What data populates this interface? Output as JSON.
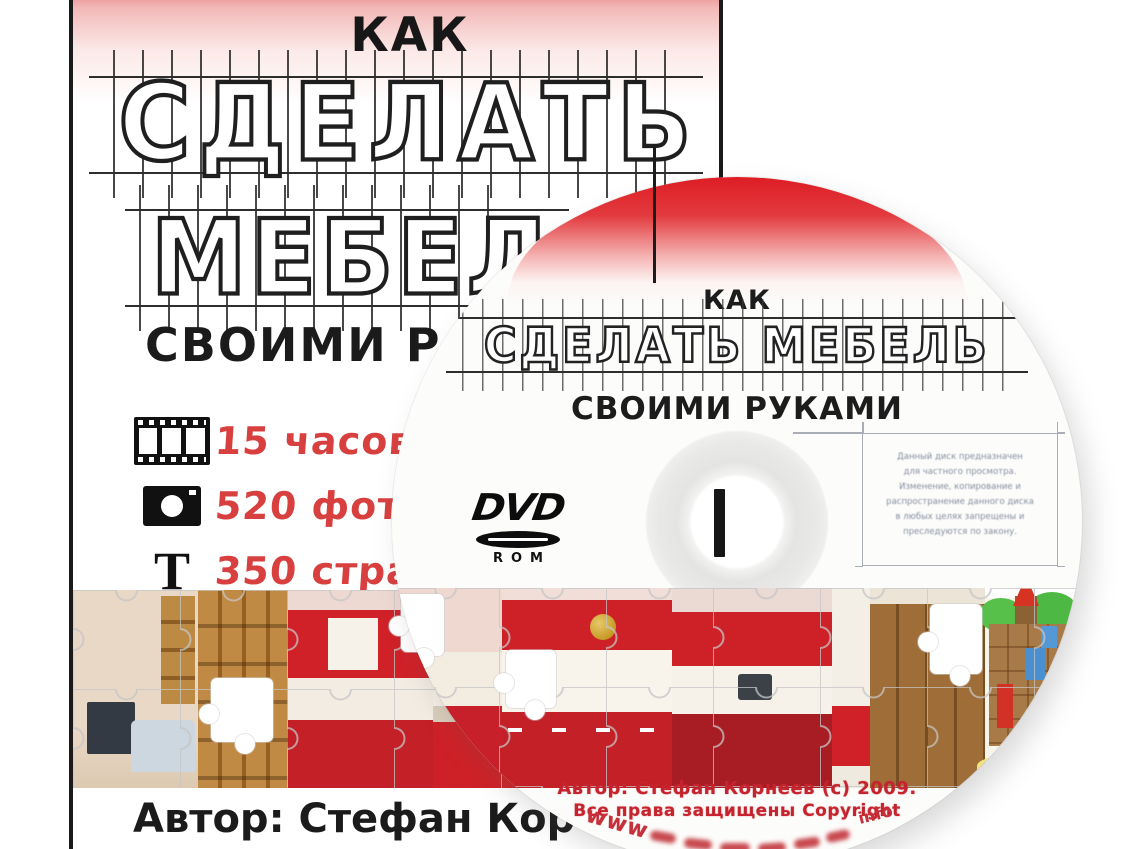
{
  "cover": {
    "kicker": "КАК",
    "title_line1": "СДЕЛАТЬ",
    "title_line2": "МЕБЕЛ",
    "subtitle": "СВОИМИ Р",
    "features": [
      {
        "icon": "film-strip-icon",
        "text": "15 часов"
      },
      {
        "icon": "camera-icon",
        "text": "520 фот"
      },
      {
        "icon": "letter-t-icon",
        "glyph": "T",
        "text": "350 стра"
      }
    ],
    "author": "Автор: Стефан Кор"
  },
  "disc": {
    "kicker": "КАК",
    "title": "СДЕЛАТЬ МЕБЕЛЬ",
    "subtitle": "СВОИМИ РУКАМИ",
    "format_logo": {
      "line1": "DVD",
      "line2": "ROM"
    },
    "legal_notice": {
      "line1": "Данный диск предназначен",
      "line2": "для частного просмотра.",
      "line3": "Изменение, копирование и",
      "line4": "распространение данного диска",
      "line5": "в любых целях запрещены и",
      "line6": "преследуются по закону."
    },
    "author_line": "Автор: Стефан Корнеев (с) 2009.",
    "rights_line": "Все права защищены Copyright",
    "url_arc": {
      "prefix": "www",
      "suffix": "info"
    }
  },
  "colors": {
    "accent_red": "#cf2127",
    "feature_text_red": "#d84040",
    "disc_text_red": "#c5242e",
    "blueprint_ink": "#1f1f1f",
    "cover_top_pink": "#e9898b"
  }
}
